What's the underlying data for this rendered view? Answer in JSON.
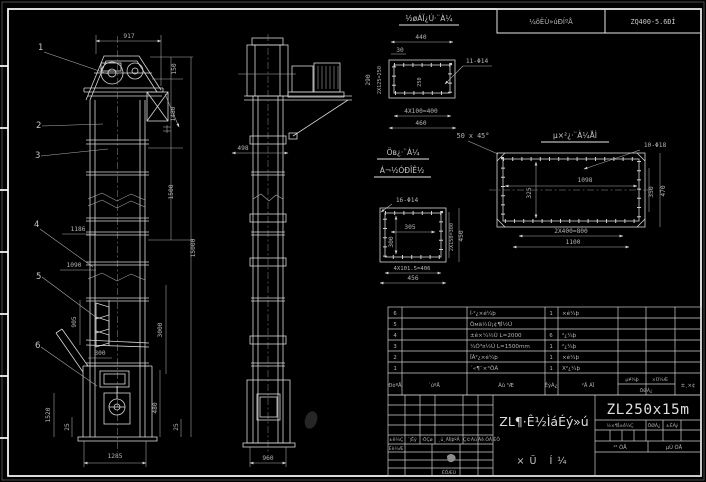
{
  "header": {
    "reducer_label": "¼õËÙ»úÐÍºÅ",
    "reducer_value": "ZQ400-5.6ÐÍ"
  },
  "front_view": {
    "balloons": [
      "1",
      "2",
      "3",
      "4",
      "5",
      "6"
    ],
    "dim_917": "917",
    "dim_150": "150",
    "dim_1480": "1480",
    "dim_1500": "1500",
    "dim_15000": "15000",
    "dim_3000": "3000",
    "dim_1186": "1186",
    "dim_1090": "1090",
    "dim_905": "905",
    "dim_300": "300",
    "dim_1520": "1520",
    "dim_25_left": "25",
    "dim_480": "480",
    "dim_25_right": "25",
    "dim_1285": "1285"
  },
  "side_view": {
    "dim_498": "498",
    "dim_960": "960"
  },
  "detail_outlet": {
    "title": "½øÁÏ¿Ú·¨À¼",
    "dim_440": "440",
    "dim_30": "30",
    "dim_290": "290",
    "dim_250": "2X125=250",
    "dim_inner": "250",
    "holes": "11-Φ14",
    "dim_400": "4X100=400",
    "dim_460": "460",
    "chamfer_note": "50 x 45°"
  },
  "detail_mid": {
    "title1": "Öв¿·¨À¼",
    "title2": "Á¬½ÓÐÎÊ½",
    "holes": "16-Φ14",
    "dim_305": "305",
    "dim_300": "300",
    "dim_right1": "2X150=300",
    "dim_450": "450",
    "dim_406": "4X101.5=406",
    "dim_456": "456"
  },
  "detail_base": {
    "title": "µ×²¿·¨À¼ÅÌ",
    "holes": "10-Φ18",
    "dim_1098": "1098",
    "dim_325": "325",
    "dim_350": "350",
    "dim_470": "470",
    "dim_800": "2X400=800",
    "dim_1100": "1100"
  },
  "bom": {
    "headers": {
      "no": "ÐòºÅ",
      "code": "´úºÅ",
      "name": "Ãû ³Æ",
      "qty": "ÊýÁ¿",
      "mat": "²Ä ÁÏ",
      "w1": "µ¥¼þ",
      "w2": "×Ü¼Æ",
      "wsub": "ÖØÁ¿",
      "rk": "±¸×¢"
    },
    "rows": [
      {
        "no": "6",
        "code": "",
        "name": "Í·²¿×é¼þ",
        "qty": "1",
        "mat": "×é¼þ"
      },
      {
        "no": "5",
        "code": "",
        "name": "Öмä½Ú¡¢¶Ì½Ú",
        "qty": "",
        "mat": ""
      },
      {
        "no": "4",
        "code": "",
        "name": "±ê×¼½Ú L=2000",
        "qty": "6",
        "mat": "²¿¼þ"
      },
      {
        "no": "3",
        "code": "",
        "name": "¼Ó³¤½Ú L=1500mm",
        "qty": "1",
        "mat": "²¿¼þ"
      },
      {
        "no": "2",
        "code": "",
        "name": "ÏÂ²¿×é¼þ",
        "qty": "1",
        "mat": "×é¼þ"
      },
      {
        "no": "1",
        "code": "",
        "name": "´«¶¯×°ÖÃ",
        "qty": "1",
        "mat": "X²¿¼þ"
      }
    ]
  },
  "titleblock": {
    "model": "ZL250x15m",
    "title_main": "ZL¶·Ê½ÌáÉý»ú",
    "title_sub": "×Ü Í¼",
    "rev_headers": [
      "±ê¼Ç",
      "´¦Êý",
      "·ÖÇø",
      "¸ü¸ÄÎļþºÅ",
      "Ç©Ãû",
      "Äê.ÔÂ.ÈÕ"
    ],
    "sig_design": "Éè¼Æ",
    "sig_date": "ÈÕÆÚ",
    "stage_label": "½×¶Î±ê¼Ç",
    "weight_label": "ÖØÁ¿",
    "scale_label": "±ÈÀý",
    "sheets_label": "¹² ÕÅ",
    "page_label": "µÚ ÕÅ"
  }
}
